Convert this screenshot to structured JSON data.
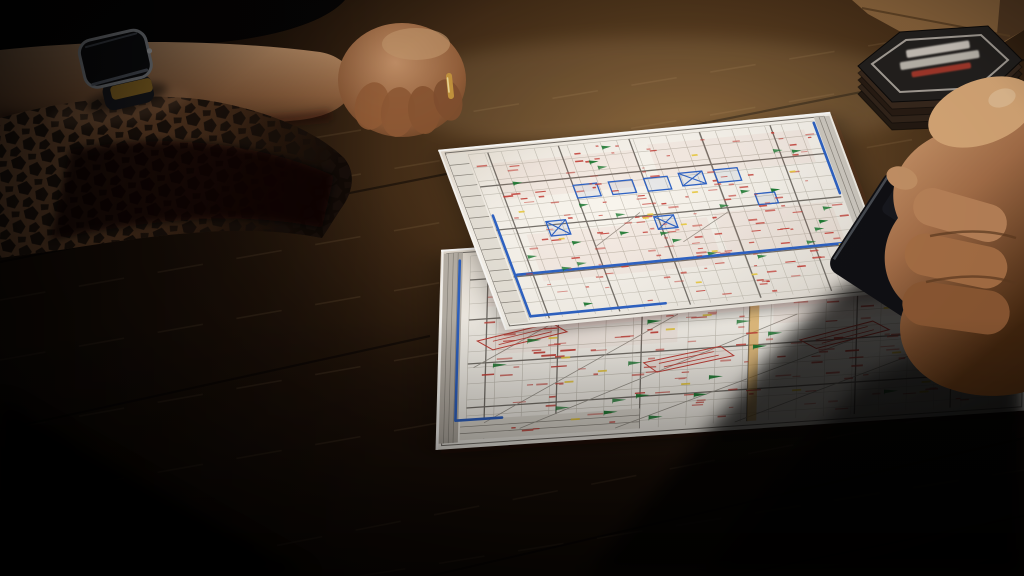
{
  "scene": {
    "description": "photo-of-construction-plans-on-dark-wood-table",
    "objects": [
      {
        "name": "wood-table",
        "material": "dark-oak"
      },
      {
        "name": "tattooed-forearm",
        "detail": "geometric-honeycomb-tattoo"
      },
      {
        "name": "smartwatch",
        "detail": "dark-face-silver-rim-gold-glint"
      },
      {
        "name": "pale-forearm",
        "detail": "resting-horizontal"
      },
      {
        "name": "clenched-fist",
        "detail": "gold-ring-on-finger"
      },
      {
        "name": "hex-coaster-stack",
        "layers": 5,
        "label_lines": 3,
        "label_legible": false
      },
      {
        "name": "wood-block",
        "position": "top-right"
      },
      {
        "name": "right-hand",
        "detail": "holding-dark-phone"
      },
      {
        "name": "phone",
        "detail": "dark-slab"
      },
      {
        "name": "plan-sheet-top",
        "type": "construction-drawing"
      },
      {
        "name": "plan-sheet-bottom",
        "type": "construction-drawing"
      }
    ]
  },
  "palette": {
    "wood-base": "#1c1008",
    "wood-mid": "#4a2f17",
    "wood-light": "#7d5a30",
    "paper": "#f8f4ec",
    "gridc": "#c6c1b6",
    "major": "#76716a",
    "blue": "#2f63c4",
    "red": "#c5423a",
    "green": "#1e7a33",
    "yellow": "#e9c93e",
    "orange": "#e0a23c",
    "tattoo": "#1a100a",
    "gold": "#c9983f",
    "coaster-top": "#23201e",
    "coaster-side": "#30231a",
    "phone": "#101014",
    "cloth": "#060404"
  },
  "sheets": [
    {
      "name": "plan-sheet-bottom",
      "matrix": [
        5.98,
        -0.4,
        -0.055,
        2.0,
        441,
        250
      ],
      "frame": [
        1,
        2,
        97,
        96
      ],
      "grid": {
        "u0": 5,
        "u1": 97,
        "du": 4.6,
        "v0": 4,
        "v1": 96,
        "dv": 8
      },
      "majors_u": [
        8,
        20,
        34,
        52,
        70,
        86
      ],
      "majors_v": [
        16,
        36,
        58,
        80
      ],
      "bands": [
        {
          "x": 0.5,
          "y": 2,
          "w": 3.2,
          "h": 95,
          "fill": "#b9b2a8",
          "cols": 4
        },
        {
          "x": 4,
          "y": 86,
          "w": 30,
          "h": 10,
          "fill": "#e3ded4",
          "rows": 3
        }
      ],
      "yellow_band": {
        "x": 52,
        "w": 1.6
      },
      "diagonals": [
        [
          8,
          88,
          40,
          40
        ],
        [
          14,
          92,
          60,
          44
        ],
        [
          30,
          95,
          70,
          58
        ],
        [
          50,
          96,
          86,
          62
        ],
        [
          6,
          60,
          26,
          30
        ]
      ],
      "blue": "M3.2,6 L3.2,86 M3.2,86 L11,86",
      "blue_boxes": [
        {
          "x": 22,
          "y": 20,
          "w": 4,
          "h": 5,
          "cross": false
        },
        {
          "x": 60,
          "y": 24,
          "w": 4,
          "h": 5,
          "cross": true
        }
      ],
      "stamps": [
        {
          "x": 14,
          "y": 46,
          "r": -28
        },
        {
          "x": 42,
          "y": 63,
          "r": -24
        },
        {
          "x": 68,
          "y": 56,
          "r": -30
        },
        {
          "x": 87,
          "y": 34,
          "r": -28
        }
      ],
      "washes": [
        [
          8,
          8,
          40,
          22
        ],
        [
          50,
          6,
          44,
          20
        ],
        [
          10,
          38,
          30,
          16
        ],
        [
          56,
          30,
          34,
          18
        ]
      ],
      "marks": {
        "red": 190,
        "green": 30,
        "yellow": 16
      },
      "seed": 11
    },
    {
      "name": "plan-sheet-top",
      "matrix": [
        3.92,
        -0.38,
        0.67,
        1.8,
        438,
        150
      ],
      "frame": [
        1.5,
        2,
        96.5,
        96
      ],
      "grid": {
        "u0": 7,
        "u1": 95,
        "du": 4.2,
        "v0": 4,
        "v1": 96,
        "dv": 7.5
      },
      "majors_u": [
        12,
        30,
        48,
        66,
        84
      ],
      "majors_v": [
        22,
        46,
        72
      ],
      "bands": [
        {
          "x": 1.5,
          "y": 3,
          "w": 5,
          "h": 94,
          "fill": "#e7e2d8",
          "rows": 16
        },
        {
          "x": 95.5,
          "y": 2,
          "w": 4,
          "h": 96,
          "fill": "#cfcac1",
          "cols": 3
        }
      ],
      "yellow_band": null,
      "diagonals": [
        [
          30,
          60,
          44,
          44
        ],
        [
          52,
          62,
          66,
          48
        ]
      ],
      "blue": "M95,5 L95,44 M7.5,38 L7.5,94 M7.5,94 L42,94 M8,71 L93,71",
      "blue_boxes": [
        {
          "x": 30,
          "y": 26,
          "w": 6,
          "h": 7,
          "cross": false
        },
        {
          "x": 39,
          "y": 26,
          "w": 6,
          "h": 7,
          "cross": false
        },
        {
          "x": 48,
          "y": 26,
          "w": 6,
          "h": 7,
          "cross": false
        },
        {
          "x": 57,
          "y": 25,
          "w": 6,
          "h": 7,
          "cross": true
        },
        {
          "x": 66,
          "y": 25,
          "w": 6,
          "h": 7,
          "cross": false
        },
        {
          "x": 20,
          "y": 44,
          "w": 5,
          "h": 8,
          "cross": true
        },
        {
          "x": 47,
          "y": 47,
          "w": 5,
          "h": 7,
          "cross": true
        },
        {
          "x": 74,
          "y": 40,
          "w": 5,
          "h": 6,
          "cross": false
        }
      ],
      "stamps": [],
      "washes": [
        [
          12,
          10,
          36,
          20
        ],
        [
          52,
          8,
          40,
          18
        ],
        [
          14,
          50,
          46,
          26
        ],
        [
          62,
          48,
          30,
          24
        ]
      ],
      "marks": {
        "red": 155,
        "green": 26,
        "yellow": 13
      },
      "seed": 7
    }
  ]
}
